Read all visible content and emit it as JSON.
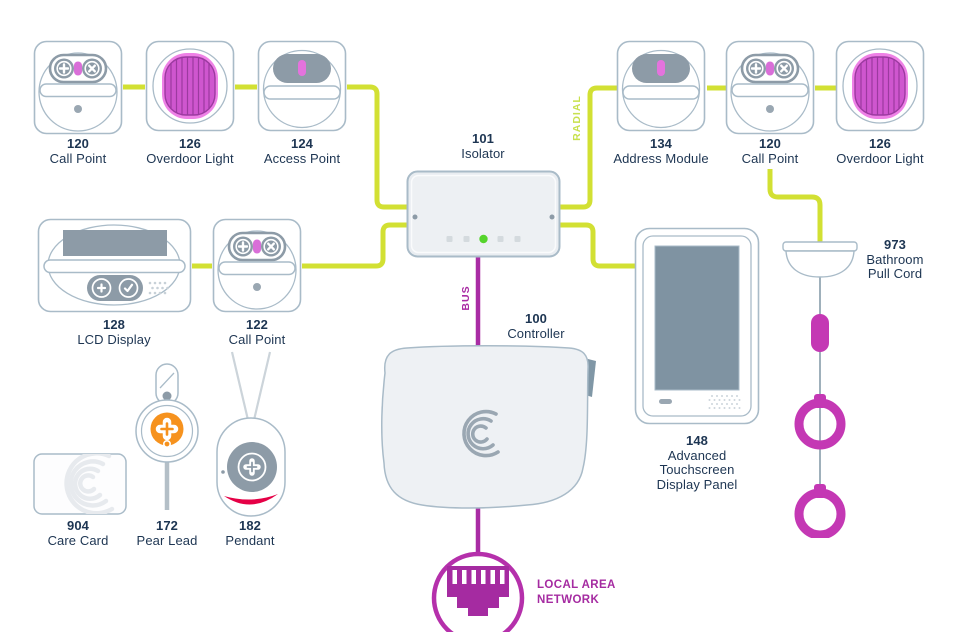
{
  "nodes": {
    "call_point_1": {
      "number": "120",
      "name": "Call Point"
    },
    "overdoor_1": {
      "number": "126",
      "name": "Overdoor Light"
    },
    "access_point": {
      "number": "124",
      "name": "Access Point"
    },
    "isolator": {
      "number": "101",
      "name": "Isolator"
    },
    "address_module": {
      "number": "134",
      "name": "Address Module"
    },
    "call_point_2": {
      "number": "120",
      "name": "Call Point"
    },
    "overdoor_2": {
      "number": "126",
      "name": "Overdoor Light"
    },
    "lcd_display": {
      "number": "128",
      "name": "LCD Display"
    },
    "call_point_3": {
      "number": "122",
      "name": "Call Point"
    },
    "controller": {
      "number": "100",
      "name": "Controller"
    },
    "touchscreen": {
      "number": "148",
      "line1": "Advanced",
      "line2": "Touchscreen",
      "line3": "Display Panel"
    },
    "pull_cord": {
      "number": "973",
      "line1": "Bathroom",
      "line2": "Pull Cord"
    },
    "care_card": {
      "number": "904",
      "name": "Care Card"
    },
    "pear_lead": {
      "number": "172",
      "name": "Pear Lead"
    },
    "pendant": {
      "number": "182",
      "name": "Pendant"
    }
  },
  "wiring": {
    "radial_label": "RADIAL",
    "bus_label": "BUS"
  },
  "lan": {
    "label_line1": "LOCAL AREA",
    "label_line2": "NETWORK"
  },
  "palette": {
    "radial_line": "#d2e033",
    "bus_line": "#a92ca4",
    "accent_magenta": "#c438b4",
    "lan_icon": "#a52ba1",
    "device_gray": "#8d9ba7",
    "outline_gray": "#a9bbc8",
    "led_green": "#55d42c",
    "alert_red": "#e50046",
    "pear_orange": "#f6921e",
    "label_text": "#1d3552"
  }
}
